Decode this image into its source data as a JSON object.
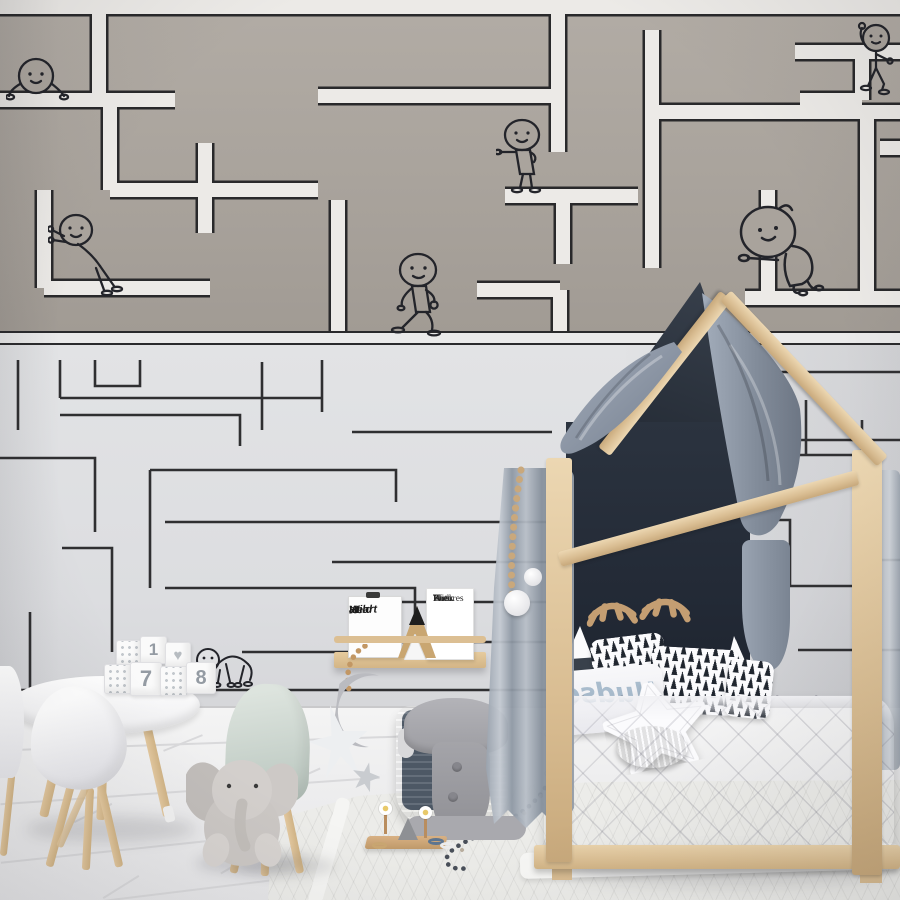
{
  "meta": {
    "scene": "Kids bedroom photo: maze wallpaper with doodle characters, house-frame bed, round play table with blocks, plush elephant",
    "palette": {
      "wall_upper_taupe": "#a9a39c",
      "maze_path_white": "#eceae7",
      "maze_line_black": "#29292b",
      "wall_lower_gray": "#dfe0e2",
      "wood_pine": "#dcc096",
      "headboard_navy": "#252c37",
      "canopy_blue_gray": "#8a94a3",
      "denim_blue": "#5d7590",
      "bedding_gray": "#d8d8dd",
      "floor_white": "#f1f1f2"
    }
  },
  "wallpaper": {
    "upper_paths": [
      "M0,7 H900",
      "M99,7 V97",
      "M0,100 H175",
      "M318,96 H558",
      "M558,7 V152",
      "M505,196 H638",
      "M563,196 V264",
      "M652,30 V268",
      "M652,112 H900",
      "M795,52 H900",
      "M862,52 V100",
      "M800,100 H862",
      "M880,148 H900",
      "M768,190 V298",
      "M745,298 H900",
      "M44,190 V288",
      "M44,288 H210",
      "M205,143 V233",
      "M110,100 V190",
      "M110,190 H318",
      "M338,200 V333",
      "M477,290 H560",
      "M560,290 V333",
      "M867,112 V298"
    ],
    "lower_paths": [
      "M18,360 V430",
      "M60,360 V398",
      "M60,398 H322",
      "M95,360 V386 H140 V360",
      "M60,415 H240 V446",
      "M0,458 H95 V532",
      "M150,470 H396 V502",
      "M150,470 V588",
      "M262,362 V430",
      "M322,360 V412",
      "M352,432 H552",
      "M165,522 H552",
      "M62,548 H112 V652",
      "M165,588 H415 V618",
      "M242,652 H362",
      "M0,690 H552",
      "M30,612 V690",
      "M332,562 H552",
      "M352,602 H552",
      "M392,642 H552",
      "M688,372 H900",
      "M688,414 H782",
      "M712,372 V394",
      "M736,440 H900",
      "M736,440 V502",
      "M756,455 H852",
      "M806,400 V455",
      "M760,520 H790 V586",
      "M760,586 H852",
      "M862,420 V520",
      "M798,650 H900",
      "M862,560 H900"
    ],
    "characters": [
      {
        "name": "character-lying",
        "x": 6,
        "y": 50
      },
      {
        "name": "character-topright",
        "x": 856,
        "y": 20
      },
      {
        "name": "character-standing",
        "x": 496,
        "y": 116
      },
      {
        "name": "character-pushing",
        "x": 48,
        "y": 210
      },
      {
        "name": "character-walking",
        "x": 388,
        "y": 250
      },
      {
        "name": "character-leaning",
        "x": 732,
        "y": 196
      },
      {
        "name": "character-waving",
        "x": 718,
        "y": 358
      },
      {
        "name": "character-bridge",
        "x": 196,
        "y": 640
      }
    ]
  },
  "shelf": {
    "frame_wild": {
      "line1": "Wild",
      "line2": "at",
      "line3": "Heart"
    },
    "book": {
      "line1": "The",
      "line2": "Book",
      "line3": "With",
      "line4": "No",
      "line5": "Pictures"
    }
  },
  "bed": {
    "pillow_word": "Hudson"
  },
  "toys": {
    "block_digit_1": "1",
    "block_digit_7": "7",
    "block_digit_8": "8",
    "block_heart": "♥"
  }
}
